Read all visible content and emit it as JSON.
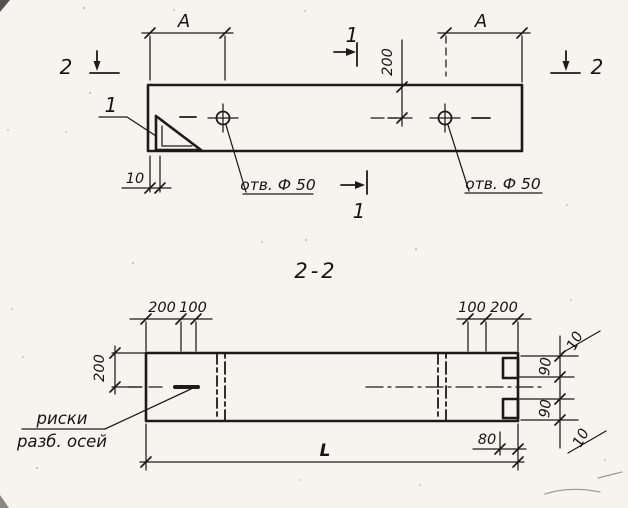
{
  "palette": {
    "paper": "#f5f4ef",
    "ink": "#1b1b1b"
  },
  "plan": {
    "dim_a_left": "A",
    "dim_a_right": "A",
    "dim_200": "200",
    "dim_10": "10",
    "hole_label_left": "отв. Ф 50",
    "hole_label_right": "отв. Ф 50",
    "detail_callout": "1",
    "section1_top": "1",
    "section1_bottom": "1",
    "section2_left": "2",
    "section2_right": "2"
  },
  "section": {
    "title": "2-2",
    "top_left_200": "200",
    "top_left_100": "100",
    "top_right_100": "100",
    "top_right_200": "200",
    "left_200": "200",
    "right_10_top": "10",
    "right_90_top": "90",
    "right_90_bottom": "90",
    "right_10_bottom": "10",
    "dim_80": "80",
    "dim_L": "L",
    "axes_note_line1": "риски",
    "axes_note_line2": "разб. осей"
  }
}
